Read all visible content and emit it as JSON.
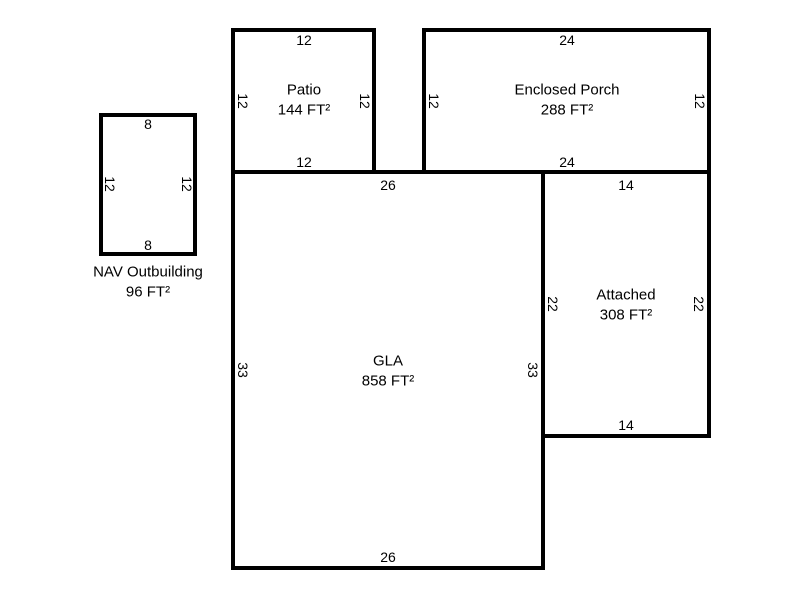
{
  "colors": {
    "wall": "#000000",
    "background": "#ffffff",
    "text": "#000000"
  },
  "areas": [
    {
      "id": "nav-outbuilding",
      "name": "NAV Outbuilding",
      "area": "96 FT²",
      "dims": {
        "top": "8",
        "bottom": "8",
        "left": "12",
        "right": "12"
      }
    },
    {
      "id": "patio",
      "name": "Patio",
      "area": "144 FT²",
      "dims": {
        "top": "12",
        "bottom": "12",
        "left": "12",
        "right": "12"
      }
    },
    {
      "id": "enclosed-porch",
      "name": "Enclosed Porch",
      "area": "288 FT²",
      "dims": {
        "top": "24",
        "bottom": "24",
        "left": "12",
        "right": "12"
      }
    },
    {
      "id": "gla",
      "name": "GLA",
      "area": "858 FT²",
      "dims": {
        "top": "26",
        "bottom": "26",
        "left": "33",
        "right": "33"
      }
    },
    {
      "id": "attached",
      "name": "Attached",
      "area": "308 FT²",
      "dims": {
        "top": "14",
        "bottom": "14",
        "left": "22",
        "right": "22"
      }
    }
  ]
}
